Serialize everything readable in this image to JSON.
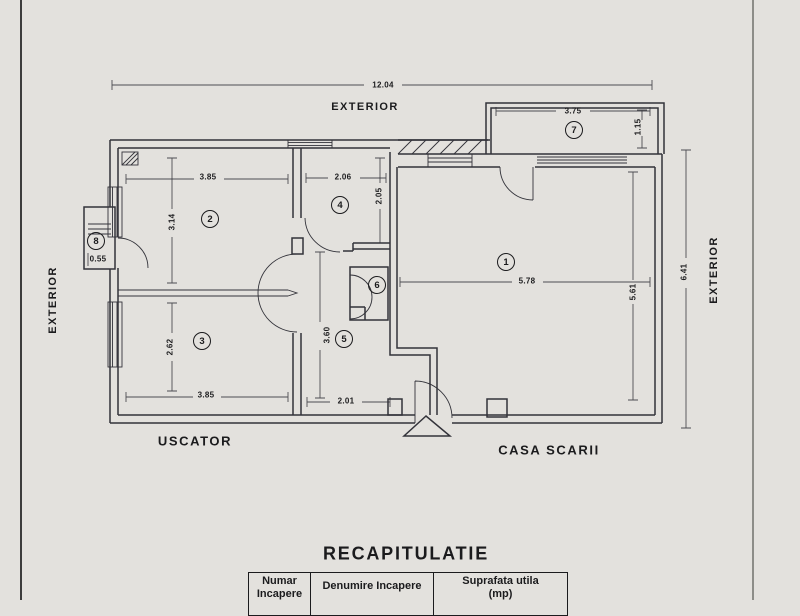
{
  "colors": {
    "paper": "#e3e1dd",
    "ink": "#33333a",
    "text": "#1b1b1d",
    "scan-edge-dark": "#3c3c3c",
    "scan-edge-gray": "#8d8d88"
  },
  "plan": {
    "exterior_top": "EXTERIOR",
    "exterior_left": "EXTERIOR",
    "exterior_right": "EXTERIOR",
    "uscator": "USCATOR",
    "casa_scarii": "CASA SCARII",
    "total_width": "12.04",
    "total_height": "6.41",
    "rooms": {
      "r1": "1",
      "r2": "2",
      "r3": "3",
      "r4": "4",
      "r5": "5",
      "r6": "6",
      "r7": "7",
      "r8": "8"
    },
    "dims": {
      "room1_w": "5.78",
      "room1_h": "5.61",
      "room2_w": "3.85",
      "room2_h": "3.14",
      "room3_w": "3.85",
      "room3_h": "2.62",
      "room4_w": "2.06",
      "room4_h": "2.05",
      "room5_h": "3.60",
      "room5_w": "2.01",
      "room7_w": "3.75",
      "room7_h": "1.15",
      "room8_w": "0.55"
    }
  },
  "recap": {
    "title": "RECAPITULATIE",
    "col1_line1": "Numar",
    "col1_line2": "Incapere",
    "col2": "Denumire Incapere",
    "col3_line1": "Suprafata utila",
    "col3_line2": "(mp)"
  }
}
